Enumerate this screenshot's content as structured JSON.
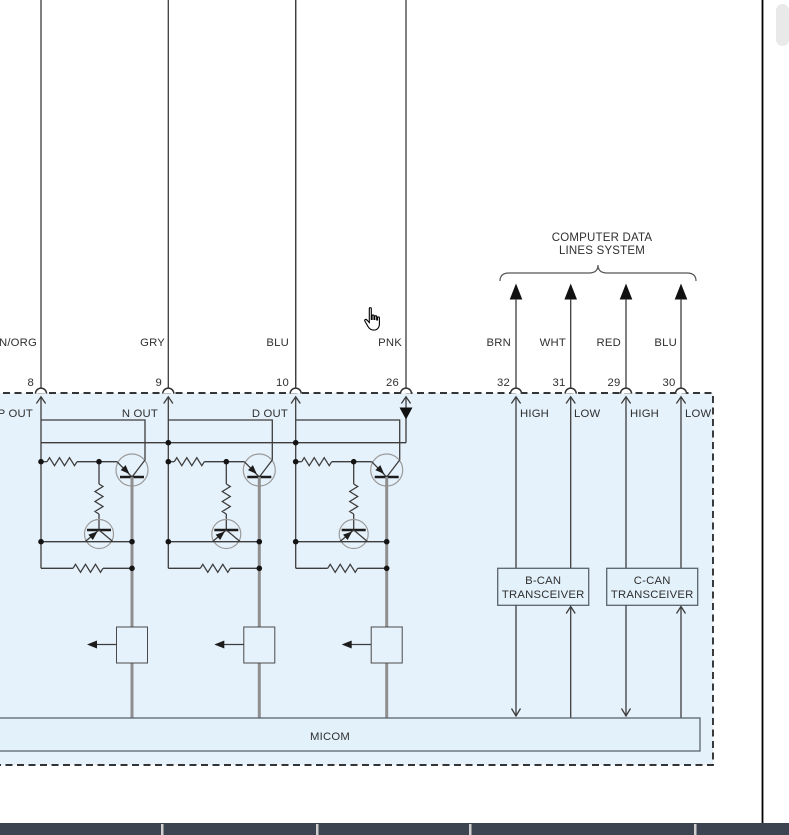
{
  "diagram": {
    "title_line1": "COMPUTER DATA",
    "title_line2": "LINES SYSTEM",
    "left_wires": [
      {
        "color_label": "N/ORG",
        "pin": "8",
        "terminal": "P OUT",
        "color": "#ab6d24"
      },
      {
        "color_label": "GRY",
        "pin": "9",
        "terminal": "N OUT",
        "color": "#cdcdcd"
      },
      {
        "color_label": "BLU",
        "pin": "10",
        "terminal": "D OUT",
        "color": "#1616f2",
        "highlight_color": "#ffff00"
      },
      {
        "color_label": "PNK",
        "pin": "26",
        "color": "#f782a5"
      }
    ],
    "can_wires": [
      {
        "color_label": "BRN",
        "pin": "32",
        "terminal": "HIGH",
        "color": "#6f5606"
      },
      {
        "color_label": "WHT",
        "pin": "31",
        "terminal": "LOW",
        "color": "#dfdfdf"
      },
      {
        "color_label": "RED",
        "pin": "29",
        "terminal": "HIGH",
        "color": "#ea1c24"
      },
      {
        "color_label": "BLU",
        "pin": "30",
        "terminal": "LOW",
        "color": "#2424d8"
      }
    ],
    "bcan_line1": "B-CAN",
    "bcan_line2": "TRANSCEIVER",
    "ccan_line1": "C-CAN",
    "ccan_line2": "TRANSCEIVER",
    "micom_label": "MICOM",
    "box_fill": "#e6f2fb"
  },
  "bottom_bar": {
    "background": "#3d4451"
  }
}
